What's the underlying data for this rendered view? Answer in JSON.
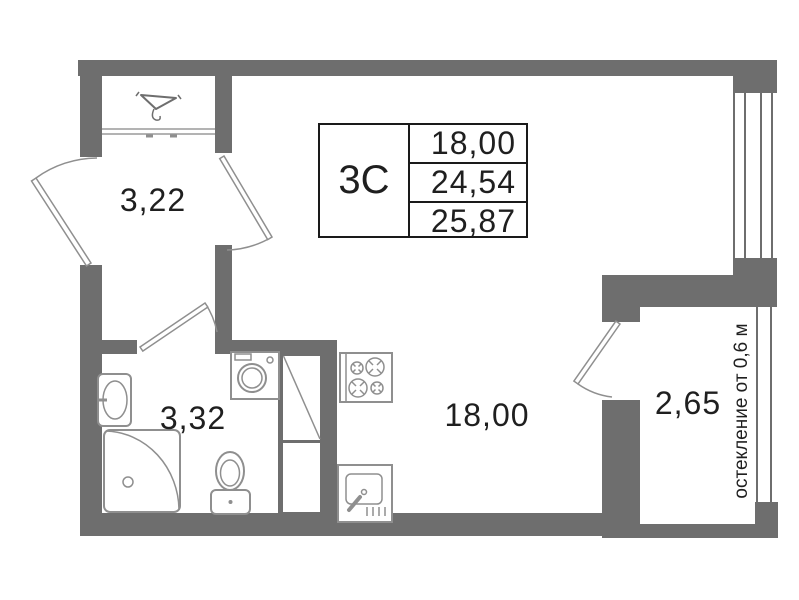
{
  "info_table": {
    "type": "3С",
    "areas": [
      "18,00",
      "24,54",
      "25,87"
    ]
  },
  "rooms": {
    "hallway": {
      "area": "3,22"
    },
    "bathroom": {
      "area": "3,32"
    },
    "living_room": {
      "area": "18,00"
    },
    "balcony": {
      "area": "2,65"
    }
  },
  "annotations": {
    "glazing": "остекление от 0,6 м"
  },
  "icons": [
    "coat-hanger-icon",
    "entrance-door",
    "wardrobe-front",
    "living-room-door",
    "bathroom-door",
    "balcony-door",
    "bathroom-sink",
    "shower",
    "toilet",
    "washing-machine",
    "ventilation-shaft",
    "stove",
    "kitchen-sink",
    "window-glazing",
    "balcony-glazing"
  ],
  "colors": {
    "wall": "#6e6e6e",
    "fixture_line": "#8f8f8f",
    "text": "#1f1f1f",
    "background": "#ffffff"
  }
}
